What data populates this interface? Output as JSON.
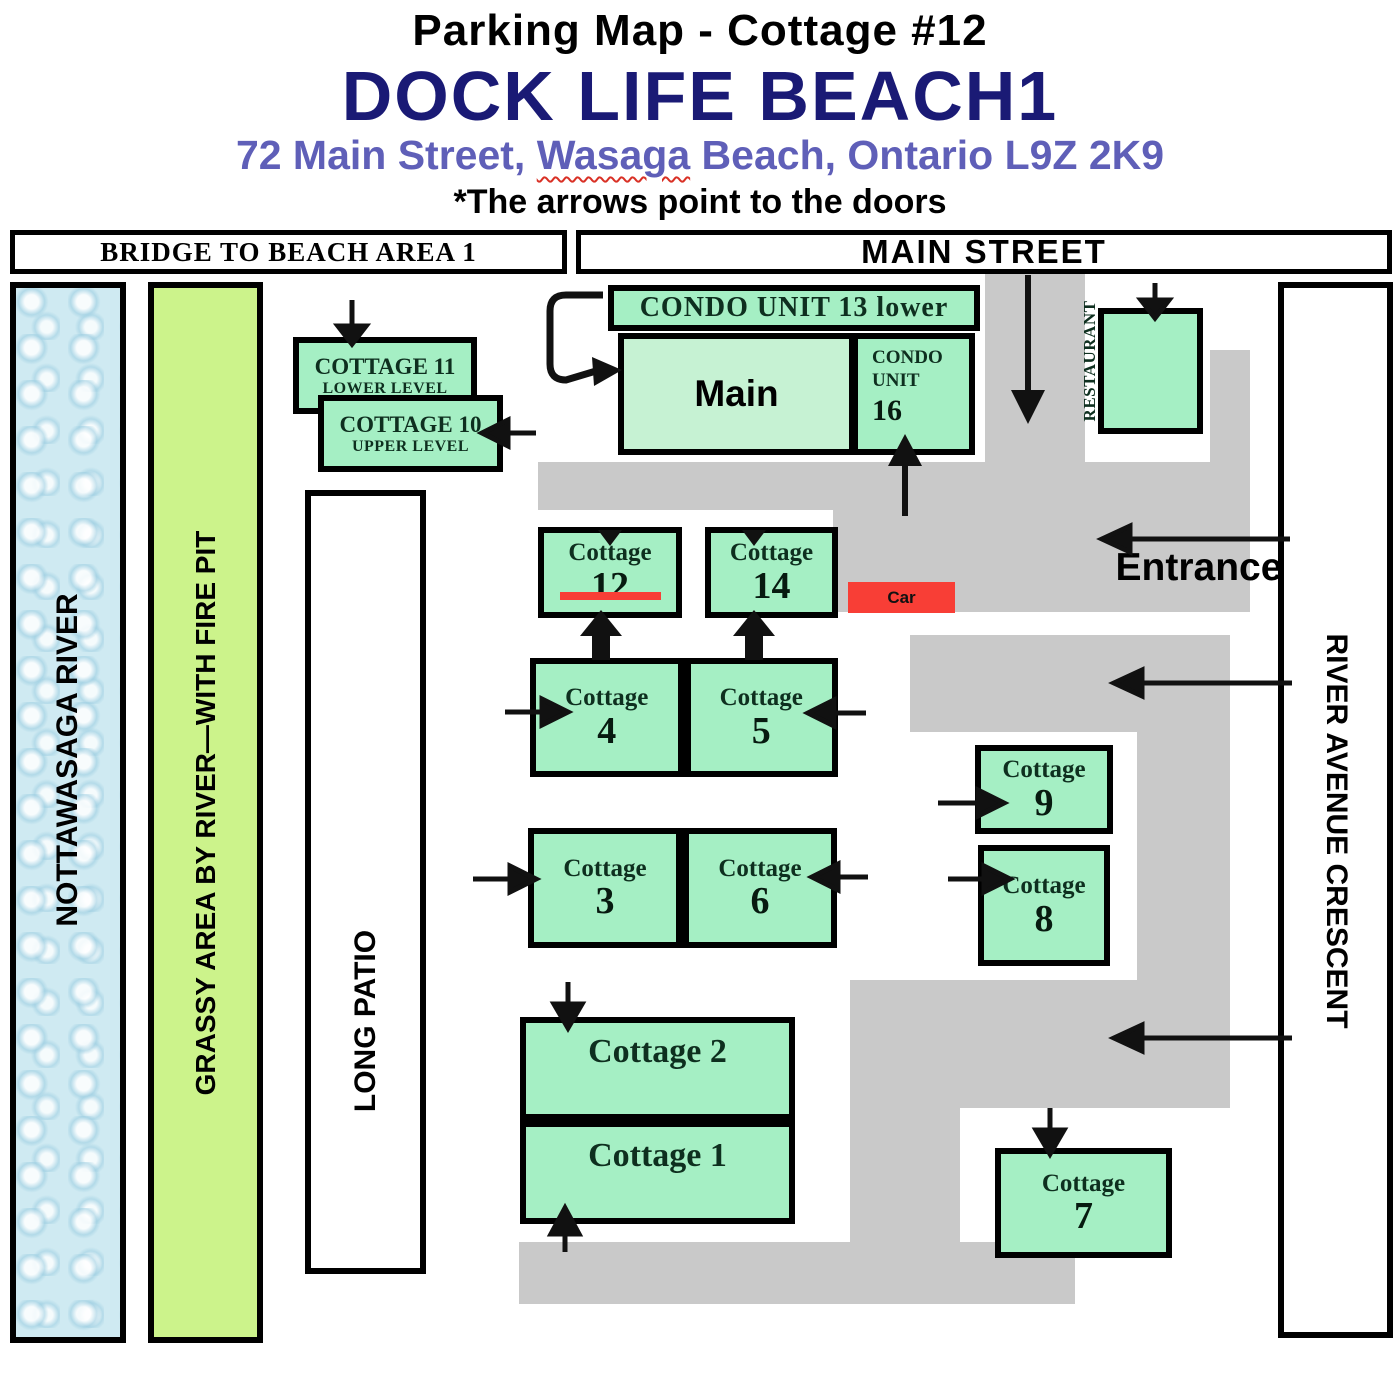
{
  "header": {
    "title": "Parking Map - Cottage #12",
    "resort_name": "DOCK LIFE BEACH1",
    "address_pre": "72 Main Street, ",
    "address_squiggle": "Wasaga",
    "address_post": " Beach, Ontario  L9Z 2K9",
    "note": "*The arrows point to the doors"
  },
  "streets": {
    "bridge": "BRIDGE TO BEACH AREA 1",
    "main_street": "MAIN STREET",
    "river_avenue": "RIVER AVENUE CRESCENT"
  },
  "strips": {
    "river": "NOTTAWASAGA RIVER",
    "grassy": "GRASSY AREA BY RIVER—WITH FIRE PIT",
    "patio": "LONG PATIO"
  },
  "buildings": {
    "condo13": "CONDO UNIT 13 lower",
    "main": "Main",
    "condo16_line1": "CONDO",
    "condo16_line2": "UNIT",
    "condo16_num": "16",
    "restaurant": "RESTAURANT",
    "cottage11_line1": "COTTAGE 11",
    "cottage11_line2": "LOWER LEVEL",
    "cottage10_line1": "COTTAGE 10",
    "cottage10_line2": "UPPER LEVEL"
  },
  "cottages": {
    "word": "Cottage",
    "c12": "12",
    "c14": "14",
    "c4": "4",
    "c5": "5",
    "c3": "3",
    "c6": "6",
    "c9": "9",
    "c8": "8",
    "c7": "7",
    "c2": "Cottage 2",
    "c1": "Cottage 1"
  },
  "markers": {
    "car": "Car",
    "entrance": "Entrance"
  },
  "colors": {
    "green": "#a5efc4",
    "maingreen": "#c6f2d3",
    "grass": "#ccf38b",
    "water": "#cfeaf2",
    "road": "#c9c9c9",
    "red": "#f83e36",
    "navy": "#1a1a75",
    "purple": "#5f5fb8"
  }
}
